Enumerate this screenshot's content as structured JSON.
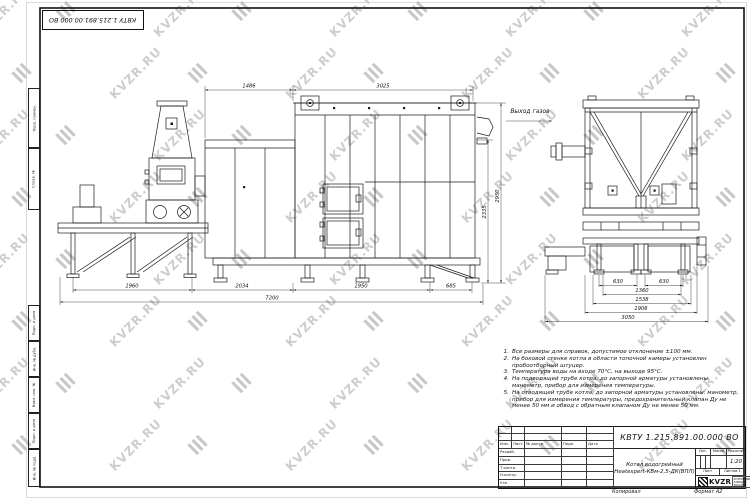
{
  "watermark": {
    "text": "KVZR.RU"
  },
  "stamp_top_left": "КВТУ 1.215.891.00.000 ВО",
  "side_strip": {
    "fields": [
      "Перв. примен.",
      "Справ. №",
      "Подп. и дата",
      "Инв. № дубл.",
      "Взам. инв. №",
      "Подп. и дата",
      "Инв. № подл."
    ]
  },
  "drawing": {
    "gas_outlet_label": "Выход газов",
    "front_view": {
      "dim_top_left": "1486",
      "dim_top_right": "3025",
      "dim_height_inner": "2335",
      "dim_height_overall": "2950",
      "dims_bottom": [
        "1960",
        "2034",
        "1950",
        "685"
      ],
      "dim_overall_width": "7200"
    },
    "side_view": {
      "dims": [
        "630",
        "630",
        "1360",
        "1538",
        "1906",
        "3050"
      ]
    }
  },
  "notes": {
    "items": [
      "Все размеры для справок, допустимое отклонение ±100 мм.",
      "На боковой стенке котла в области топочной камеры установлен пробоотборный штуцер.",
      "Температура воды на входе 70°С, на выходе 95°С.",
      "На подводящей трубе котла, до запорной арматуры установлены манометр, прибор для измерения температуры.",
      "На отводящей трубе котла, до запорной арматуры установлены: манометр, прибор для измерения температуры, предохранительный клапан Ду не менее 50 мм и обвод с обратным клапаном Ду не менее 50 мм."
    ]
  },
  "title_block": {
    "doc_number": "КВТУ 1.215.891.00.000 ВО",
    "product_line1": "Котел водогрейный",
    "product_line2": "Heatexpert-КВм-2,5-ДК(ВПЛ)",
    "header_cols": [
      "Изм.",
      "Лист",
      "№ докум.",
      "Подп.",
      "Дата"
    ],
    "sign_rows": [
      "Разраб.",
      "Пров.",
      "Т.контр.",
      "Н.контр.",
      "Утв."
    ],
    "lit_label": "Лит.",
    "mass_label": "Масса",
    "scale_label": "Масштаб",
    "scale_value": "1:20",
    "sheet_label": "Лист",
    "sheets_label": "Листов",
    "sheets_value": "1",
    "brand": "KVZR",
    "brand_sub1": "КОТЕЛЬНЫЕ",
    "brand_sub2": "ЗАВОДЫ РОССИИ",
    "footer_copy": "Копировал",
    "footer_format": "Формат А2"
  }
}
